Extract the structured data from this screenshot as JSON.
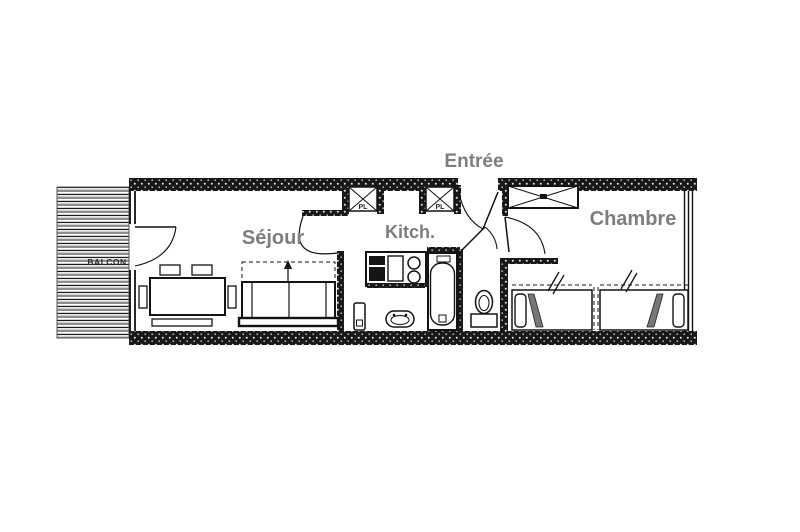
{
  "plan": {
    "title": "Studio apartment floor plan",
    "labels": {
      "entrance": "Entrée",
      "living_room": "Séjour",
      "kitchen": "Kitch.",
      "bedroom": "Chambre",
      "balcony": "BALCON",
      "closet_left": "PL",
      "closet_right": "PL"
    },
    "colors": {
      "background": "#ffffff",
      "linework": "#111111",
      "room_label": "#7d7d7d",
      "wall_fill": "#181818",
      "balcony_stripe": "#8d8d8d"
    }
  }
}
